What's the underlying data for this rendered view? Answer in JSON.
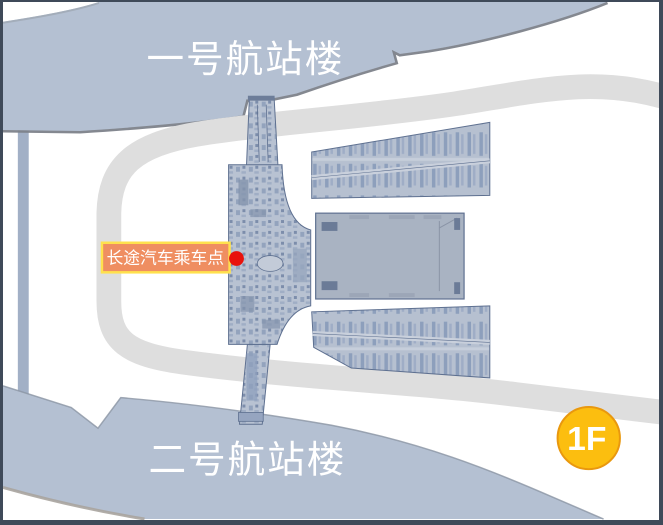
{
  "map": {
    "terminal1_label": "一号航站楼",
    "terminal2_label": "二号航站楼",
    "poi": {
      "label": "长途汽车乘车点"
    },
    "floor_badge": {
      "label": "1F"
    },
    "colors": {
      "terminal_fill": "#b4c0d2",
      "terminal_text": "#ffffff",
      "road_gray": "#dedede",
      "side_road": "#a2b0c6",
      "plan_fill": "#b8c2d2",
      "plan_line": "#5e7090",
      "plan_dark": "#8d9fbc",
      "mid_hall_fill": "#a9b3c2",
      "poi_bg": "#ef8e61",
      "poi_border": "#ffe14d",
      "poi_text": "#ffffff",
      "poi_dot": "#e8120c",
      "badge_fill": "#fcbe0f",
      "badge_border": "#e9980e",
      "badge_text": "#ffffff",
      "frame_border": "#3f4a59"
    }
  }
}
